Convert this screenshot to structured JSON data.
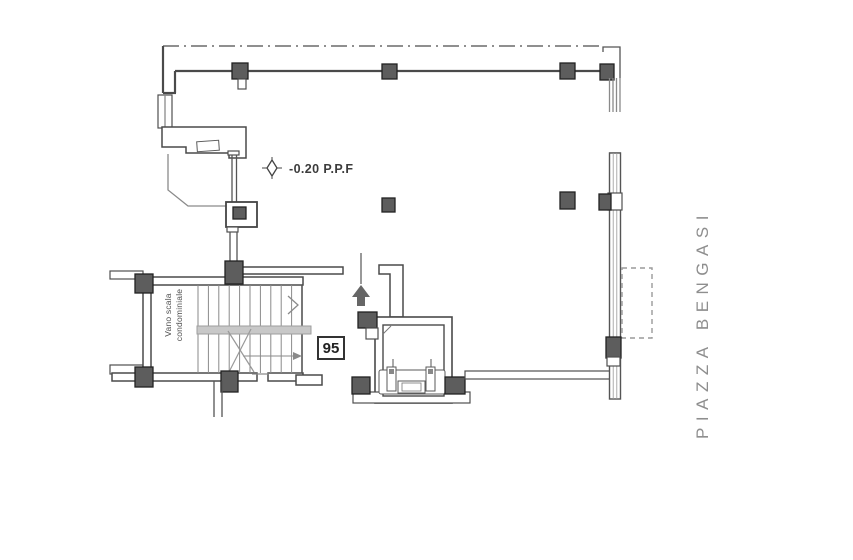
{
  "document": {
    "type": "architectural floor plan",
    "level_label": "-0.20 P.P.F",
    "unit_number": "95",
    "stairwell_label_line1": "Vano scala",
    "stairwell_label_line2": "condominiale",
    "street_name": "PIAZZA BENGASI"
  },
  "colors": {
    "background": "#ffffff",
    "wall": "#4a4a4a",
    "thin": "#8a8a8a",
    "column_fill": "#5d5d5d",
    "column_stroke": "#222222",
    "landing_fill": "#c8c8c8",
    "street_text": "#8e8e8e",
    "label_text": "#3c3c3c"
  },
  "stairs": {
    "tread_lines": 11
  }
}
